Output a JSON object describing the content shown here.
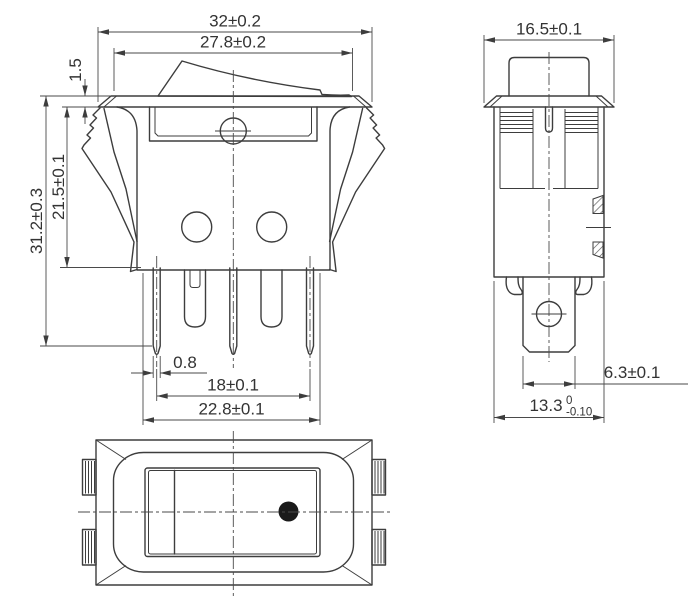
{
  "colors": {
    "line": "#3d3d3d",
    "dimension_line": "#4a4a4a",
    "text": "#333333",
    "indicator_dot": "#1a1a1a",
    "background": "#ffffff"
  },
  "front_view": {
    "dim_flange_outer_width": "32±0.2",
    "dim_flange_top_width": "27.8±0.2",
    "dim_flange_thickness": "1.5",
    "dim_flange_to_body_bottom": "21.5±0.1",
    "dim_total_height": "31.2±0.3",
    "dim_pin_thickness": "0.8",
    "dim_outer_pin_spacing": "18±0.1",
    "dim_base_width": "22.8±0.1"
  },
  "side_view": {
    "dim_flange_width": "16.5±0.1",
    "dim_terminal_width": "6.3±0.1",
    "dim_body_width_nominal": "13.3",
    "dim_body_width_tol_upper": "0",
    "dim_body_width_tol_lower": "-0.10"
  }
}
